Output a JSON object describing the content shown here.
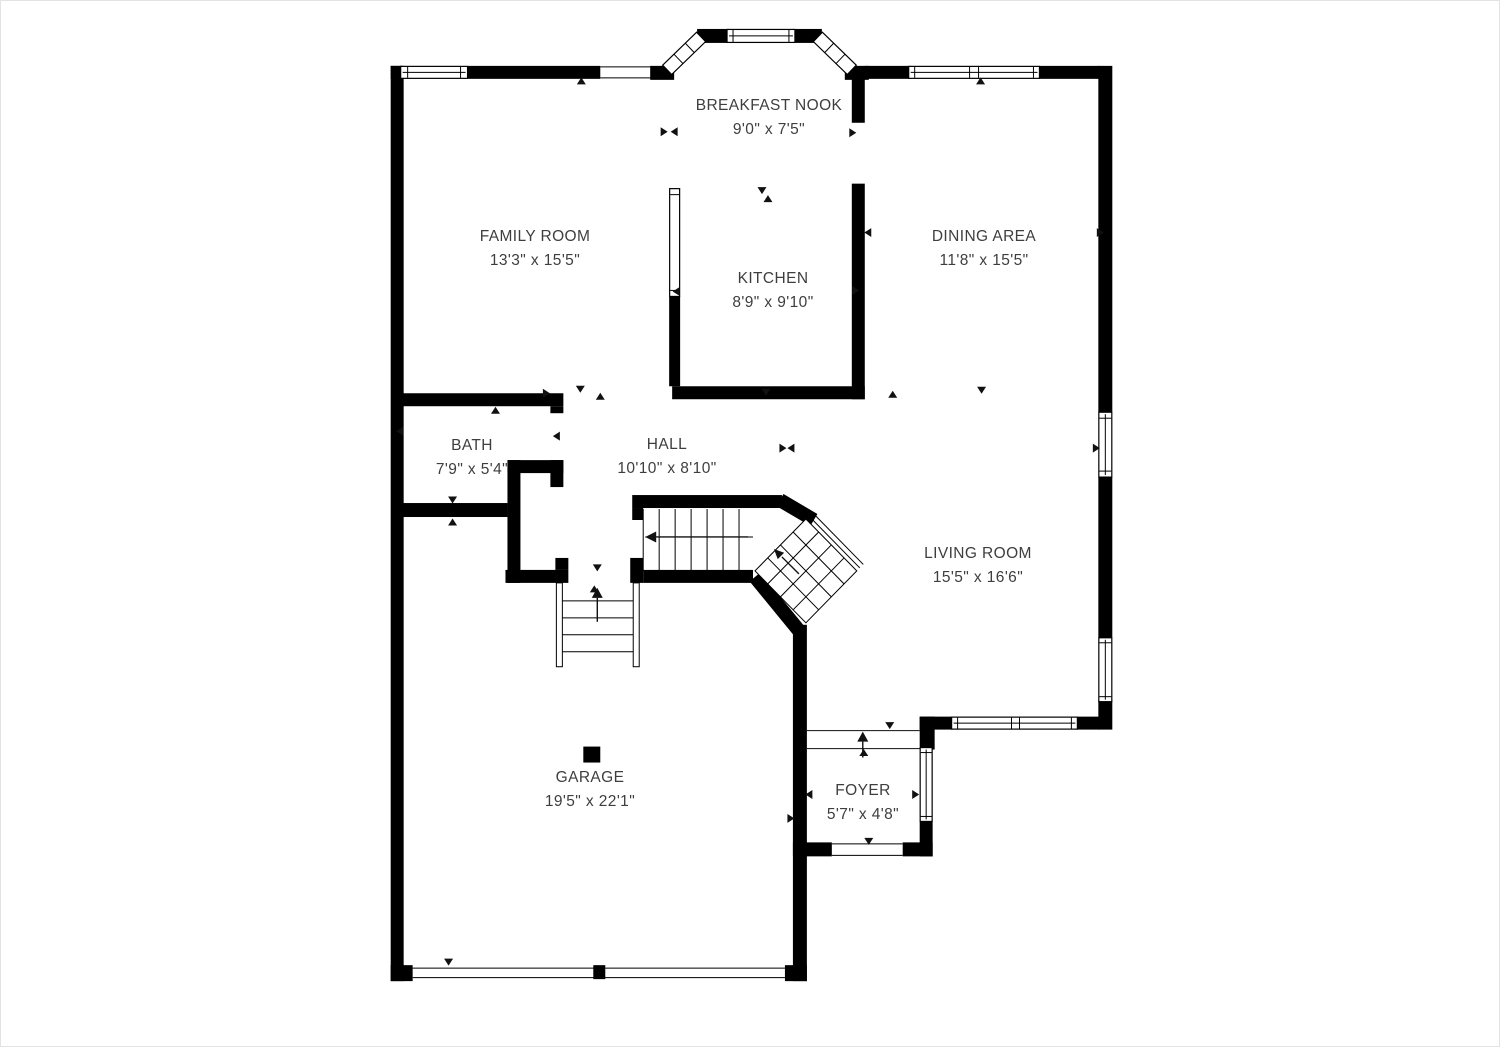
{
  "theme": {
    "background": "#ffffff",
    "wall": "#000000",
    "text": "#3e3e3e",
    "frame": "#e3e3e3"
  },
  "plan_symbols": {
    "direction_marker": "small solid triangle",
    "stairs_up_arrow": "arrow along stair run",
    "entry_arrow": "arrow through foyer threshold",
    "support_post": "solid square column in garage"
  },
  "rooms": [
    {
      "id": "breakfast-nook",
      "name": "BREAKFAST NOOK",
      "dimensions": "9'0\" x 7'5\""
    },
    {
      "id": "family-room",
      "name": "FAMILY ROOM",
      "dimensions": "13'3\" x 15'5\""
    },
    {
      "id": "dining-area",
      "name": "DINING AREA",
      "dimensions": "11'8\" x 15'5\""
    },
    {
      "id": "kitchen",
      "name": "KITCHEN",
      "dimensions": "8'9\" x 9'10\""
    },
    {
      "id": "bath",
      "name": "BATH",
      "dimensions": "7'9\" x 5'4\""
    },
    {
      "id": "hall",
      "name": "HALL",
      "dimensions": "10'10\" x 8'10\""
    },
    {
      "id": "living-room",
      "name": "LIVING ROOM",
      "dimensions": "15'5\" x 16'6\""
    },
    {
      "id": "garage",
      "name": "GARAGE",
      "dimensions": "19'5\" x 22'1\""
    },
    {
      "id": "foyer",
      "name": "FOYER",
      "dimensions": "5'7\" x 4'8\""
    }
  ]
}
